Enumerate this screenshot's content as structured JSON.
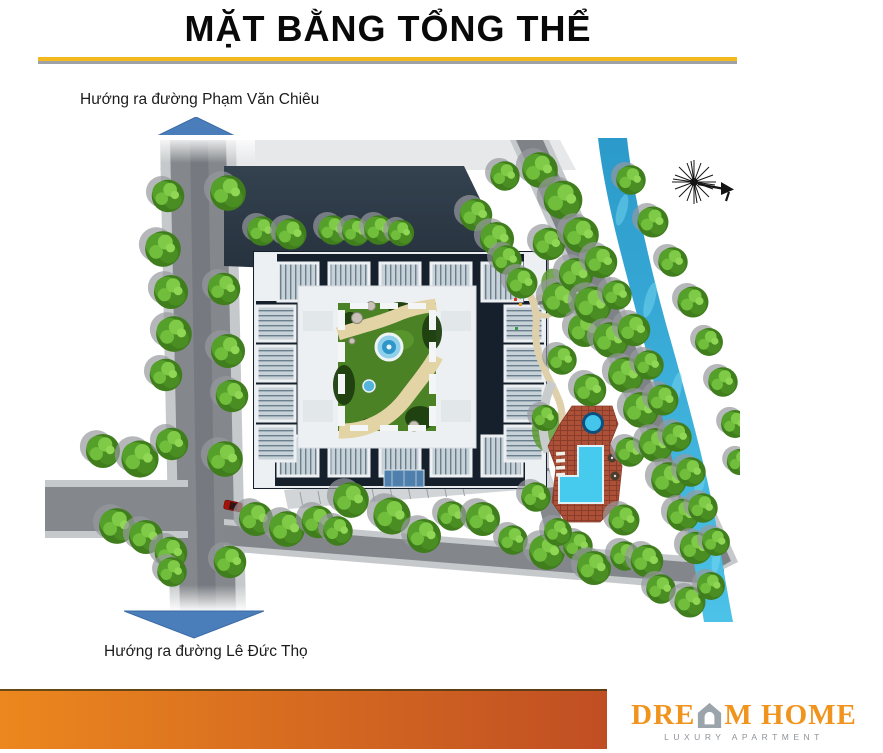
{
  "slide": {
    "title": "MẶT BẰNG TỔNG THỂ"
  },
  "annotations": {
    "top_label": "Hướng ra đường Phạm Văn Chiêu",
    "bottom_label": "Hướng ra đường Lê Đức Thọ"
  },
  "logo": {
    "word_start": "DRE",
    "word_end": "M HOME",
    "subtitle": "LUXURY APARTMENT"
  },
  "icons": {
    "up_arrow": "arrow-up-icon",
    "down_arrow": "arrow-down-icon",
    "compass": "compass-rose-icon",
    "logo_house": "house-icon"
  },
  "colors": {
    "arrow_blue": "#4A7EBB",
    "divider_gold": "#F2BA1E",
    "divider_gray": "#9EA1A5",
    "footer_grad_start": "#EC871E",
    "footer_grad_end": "#C04E23",
    "logo_orange": "#F0941D",
    "logo_gray": "#9BA3AB"
  }
}
